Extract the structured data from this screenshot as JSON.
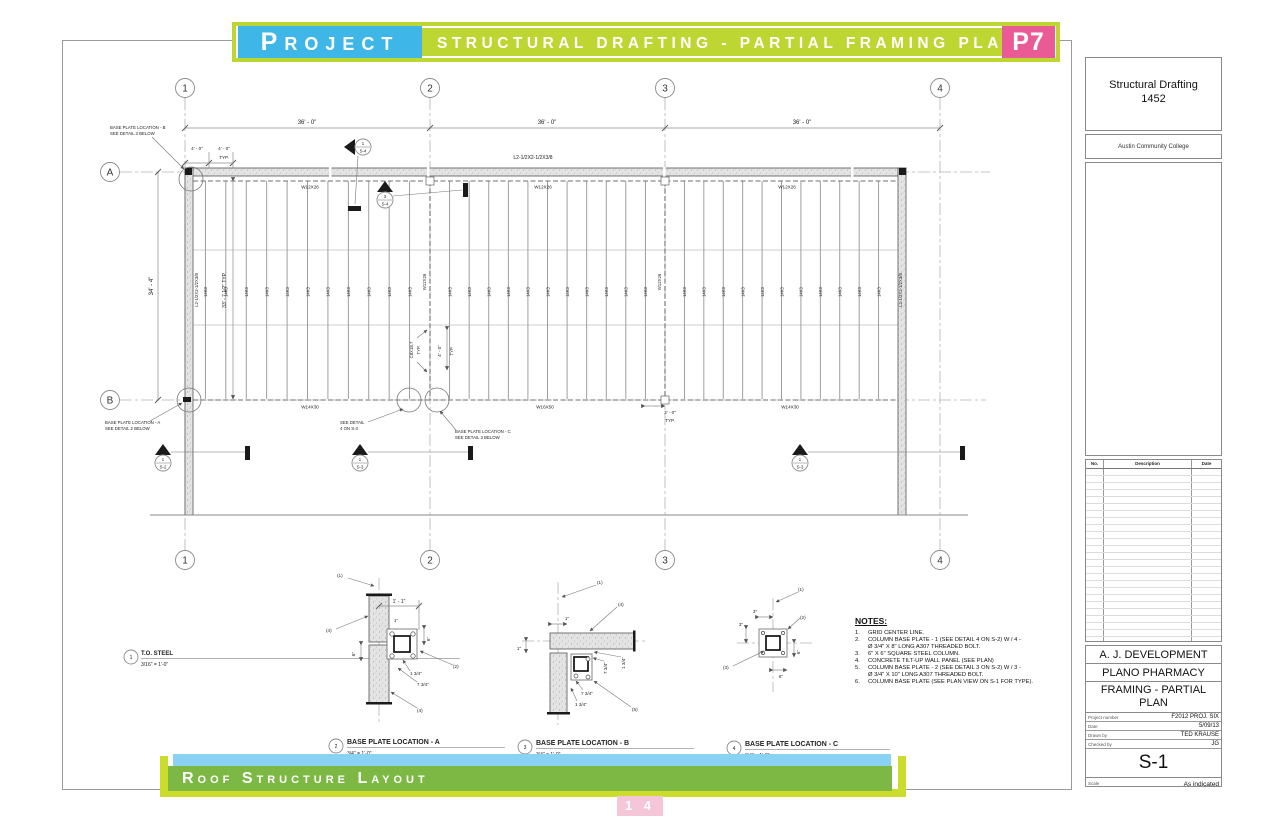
{
  "header": {
    "project_label": "Project",
    "banner_title": "STRUCTURAL DRAFTING - PARTIAL FRAMING PLAN",
    "page_code": "P7",
    "colors": {
      "cyan": "#3eb7e8",
      "green": "#bdd631",
      "pink": "#ea5b95"
    }
  },
  "sheet": {
    "grid_bubbles_top": [
      "1",
      "2",
      "3",
      "4"
    ],
    "grid_bubbles_left": [
      "A",
      "B"
    ],
    "dim_bay": "36' - 0\"",
    "dim_height": "34' - 4\"",
    "dim_joist_span": "33' - 7 1/2\" TYP.",
    "dim_4ft": "4' - 0\"",
    "dim_3ft": "3' - 0\"",
    "typ": "TYP.",
    "angle_lintel": "L2-1/2X2-1/2X3/8",
    "beam_top": "W12X26",
    "beam_bottom_left": "W14X30",
    "beam_bottom_mid": "W16X50",
    "beam_bottom_right": "W14X30",
    "column_beam": "W12X26",
    "joist": "14K3",
    "channel": "C8X18.7",
    "note_bp_b": [
      "BASE PLATE LOCATION - B",
      "SEE DETAIL 3 BELOW"
    ],
    "note_bp_a": [
      "BASE PLATE LOCATION - A",
      "SEE DETAIL 2 BELOW"
    ],
    "note_bp_c": [
      "BASE PLATE LOCATION - C",
      "SEE DETAIL 3 BELOW"
    ],
    "note_see_detail": [
      "SEE DETAIL",
      "4 ON S-3"
    ],
    "sections": {
      "s4_1": {
        "num": "1",
        "sheet": "S-4"
      },
      "s4_3": {
        "num": "3",
        "sheet": "S-4"
      },
      "s2_1": {
        "num": "1",
        "sheet": "S-2"
      },
      "s3_1": {
        "num": "1",
        "sheet": "S-3"
      }
    }
  },
  "views": {
    "callouts": {
      "c1": "(1)",
      "c2": "(2)",
      "c3": "(3)",
      "c4": "(4)",
      "c5": "(5)"
    },
    "v1": {
      "num": "1",
      "title": "T.O. STEEL",
      "scale": "3/16\" = 1'-0\""
    },
    "v2": {
      "num": "2",
      "title": "BASE PLATE LOCATION - A",
      "scale": "3/4\" = 1'-0\"",
      "dims": {
        "width": "1' - 1\"",
        "edge": "1\"",
        "six": "6\"",
        "off1": "1 3/4\"",
        "off2": "7 3/4\""
      }
    },
    "v3": {
      "num": "3",
      "title": "BASE PLATE LOCATION - B",
      "scale": "3/4\" = 1'-0\"",
      "dims": {
        "edge": "1\"",
        "plate1": "7 3/4\"",
        "plate2": "1 3/4\""
      }
    },
    "v4": {
      "num": "4",
      "title": "BASE PLATE LOCATION - C",
      "scale": "3/4\" = 1'-0\"",
      "dims": {
        "three": "3\"",
        "six": "6\""
      }
    }
  },
  "notes": {
    "title": "NOTES:",
    "items": [
      {
        "num": "1.",
        "lines": [
          "GRID CENTER LINE."
        ]
      },
      {
        "num": "2.",
        "lines": [
          "COLUMN BASE PLATE - 1  (SEE DETAIL 4 ON S-2) W / 4 -",
          "Ø 3/4\" X 8\" LONG A307 THREADED BOLT."
        ]
      },
      {
        "num": "3.",
        "lines": [
          "6\" X 6\" SQUARE STEEL COLUMN."
        ]
      },
      {
        "num": "4.",
        "lines": [
          "CONCRETE TILT-UP WALL PANEL (SEE PLAN)"
        ]
      },
      {
        "num": "5.",
        "lines": [
          "COLUMN BASE PLATE - 2 (SEE DETAIL 3 ON S-2) W / 3 -",
          "Ø 3/4\" X 10\" LONG A307 THREADED BOLT."
        ]
      },
      {
        "num": "6.",
        "lines": [
          "COLUMN BASE PLATE (SEE PLAN VIEW ON S-1 FOR TYPE)."
        ]
      }
    ]
  },
  "titleblock": {
    "course_line1": "Structural Drafting",
    "course_line2": "1452",
    "school": "Austin Community College",
    "rev_headers": [
      "No.",
      "Description",
      "Date"
    ],
    "company": "A. J. DEVELOPMENT",
    "project": "PLANO PHARMACY",
    "sheet_title_line1": "FRAMING - PARTIAL",
    "sheet_title_line2": "PLAN",
    "fields": [
      {
        "label": "Project number",
        "value": "F2012 PROJ. SIX"
      },
      {
        "label": "Date",
        "value": "5/09/13"
      },
      {
        "label": "Drawn by",
        "value": "TED KRAUSE"
      },
      {
        "label": "Checked by",
        "value": "JG"
      }
    ],
    "sheet_number": "S-1",
    "scale_label": "Scale",
    "scale_value": "As indicated"
  },
  "footer": {
    "layout_title": "Roof Structure Layout",
    "page_number": "1 4"
  }
}
